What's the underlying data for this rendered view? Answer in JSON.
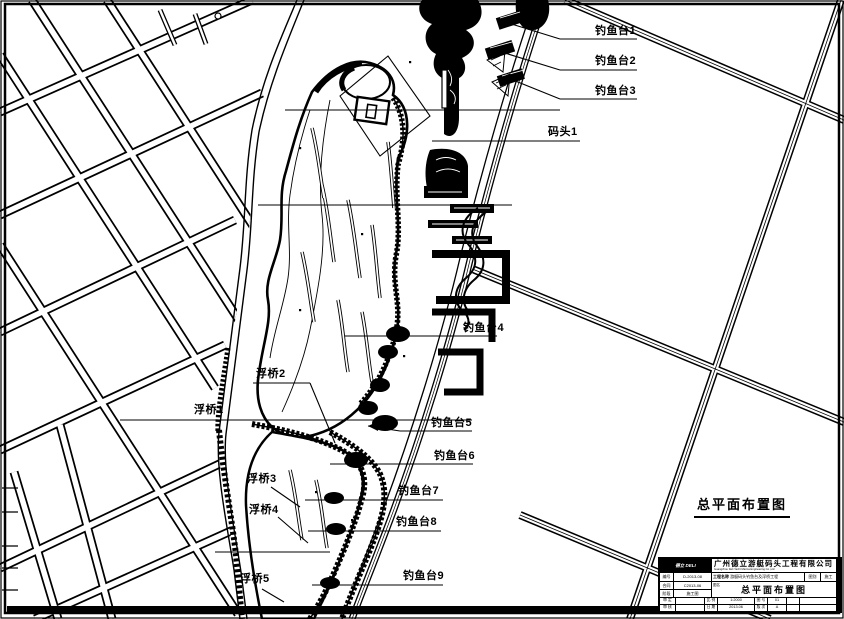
{
  "plan": {
    "title": "总平面布置图",
    "labels": [
      {
        "id": "fishing-platform-1",
        "text": "钓鱼台1"
      },
      {
        "id": "fishing-platform-2",
        "text": "钓鱼台2"
      },
      {
        "id": "fishing-platform-3",
        "text": "钓鱼台3"
      },
      {
        "id": "dock-1",
        "text": "码头1"
      },
      {
        "id": "fishing-platform-4",
        "text": "钓鱼台4"
      },
      {
        "id": "fishing-platform-5",
        "text": "钓鱼台5"
      },
      {
        "id": "fishing-platform-6",
        "text": "钓鱼台6"
      },
      {
        "id": "fishing-platform-7",
        "text": "钓鱼台7"
      },
      {
        "id": "fishing-platform-8",
        "text": "钓鱼台8"
      },
      {
        "id": "fishing-platform-9",
        "text": "钓鱼台9"
      },
      {
        "id": "pontoon-bridge-1",
        "text": "浮桥1"
      },
      {
        "id": "pontoon-bridge-2",
        "text": "浮桥2"
      },
      {
        "id": "pontoon-bridge-3",
        "text": "浮桥3"
      },
      {
        "id": "pontoon-bridge-4",
        "text": "浮桥4"
      },
      {
        "id": "pontoon-bridge-5",
        "text": "浮桥5"
      }
    ]
  },
  "title_block": {
    "logo": "德立 DELI",
    "company_cn": "广州德立游艇码头工程有限公司",
    "company_en": "Guangzhou Deli Yacht Marina Engineering Co.,Ltd",
    "row_project": {
      "no_label": "编号",
      "no_value": "D-2013-08",
      "project_label": "工程名称",
      "project_value": "游艇码头钓鱼台及浮桥工程",
      "class_label": "图别",
      "class_value": "施工"
    },
    "row_contract": {
      "label": "合同",
      "value": "C2013-06"
    },
    "row_stage": {
      "label": "阶段",
      "value": "施工图"
    },
    "drawing_name_label": "图名",
    "drawing_name": "总平面布置图",
    "bottom_rows": [
      {
        "l1": "审 定",
        "v1": "",
        "l2": "比 例",
        "v2": "1:2000",
        "l3": "图 号",
        "v3": "01"
      },
      {
        "l1": "审 核",
        "v1": "",
        "l2": "日 期",
        "v2": "2013.06",
        "l3": "版 次",
        "v3": "A"
      }
    ]
  },
  "colors": {
    "line": "#000000",
    "paper": "#ffffff"
  }
}
